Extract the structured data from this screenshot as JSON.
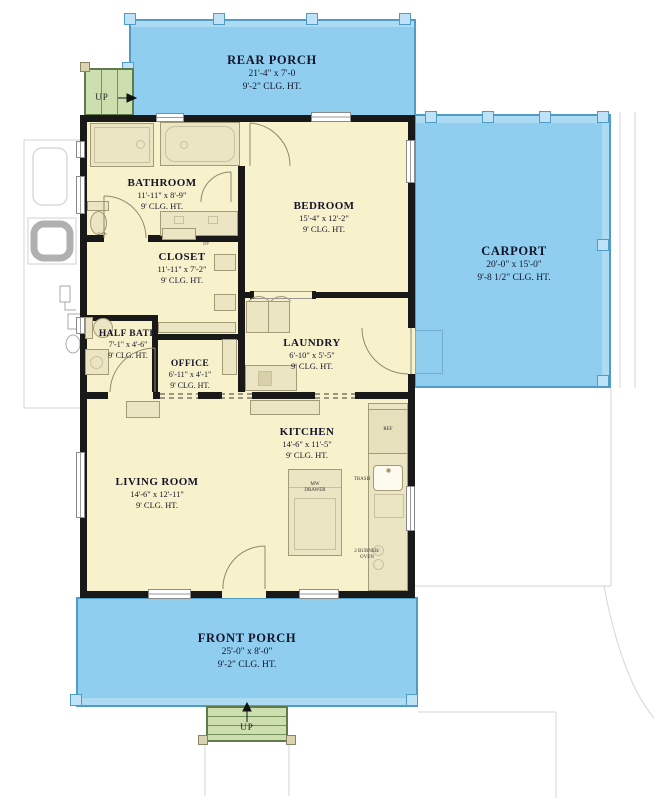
{
  "plan": {
    "rooms": {
      "rear_porch": {
        "name": "REAR PORCH",
        "dims": "21'-4\" x 7'-0",
        "clg": "9'-2\" CLG. HT."
      },
      "carport": {
        "name": "CARPORT",
        "dims": "20'-0\" x 15'-0\"",
        "clg": "9'-8 1/2\" CLG. HT."
      },
      "bathroom": {
        "name": "BATHROOM",
        "dims": "11'-11\" x 8'-9\"",
        "clg": "9' CLG. HT."
      },
      "bedroom": {
        "name": "BEDROOM",
        "dims": "15'-4\" x 12'-2\"",
        "clg": "9' CLG. HT."
      },
      "closet": {
        "name": "CLOSET",
        "dims": "11'-11\" x 7'-2\"",
        "clg": "9' CLG. HT."
      },
      "half_bath": {
        "name": "HALF BATH",
        "dims": "7'-1\" x 4'-6\"",
        "clg": "9' CLG. HT."
      },
      "office": {
        "name": "OFFICE",
        "dims": "6'-11\" x 4'-1\"",
        "clg": "9' CLG. HT."
      },
      "laundry": {
        "name": "LAUNDRY",
        "dims": "6'-10\" x 5'-5\"",
        "clg": "9' CLG. HT."
      },
      "kitchen": {
        "name": "KITCHEN",
        "dims": "14'-6\" x 11'-5\"",
        "clg": "9' CLG. HT."
      },
      "living_room": {
        "name": "LIVING ROOM",
        "dims": "14'-6\" x 12'-11\"",
        "clg": "9' CLG. HT."
      },
      "front_porch": {
        "name": "FRONT PORCH",
        "dims": "25'-0\" x 8'-0\"",
        "clg": "9'-2\" CLG. HT."
      }
    },
    "annotations": {
      "stairs_rear_up": "UP",
      "stairs_front_up": "UP",
      "ref": "REF",
      "trash": "TRASH",
      "mw_line1": "MW",
      "mw_line2": "DRAWER",
      "burner_line1": "2 BURNER/",
      "burner_line2": "OVEN",
      "lumber": "2 x 6",
      "dp": "DP"
    },
    "colors": {
      "porch": "#8fceef",
      "porch_border": "#4f9dc7",
      "porch_post": "#bfe2f6",
      "house": "#f8f2cc",
      "wall": "#191919",
      "stairs": "#cddfae",
      "stairs_border": "#5f7a4b",
      "fixture": "#ece5c3",
      "fixture_border": "#a39a76",
      "window_border": "#8a8a8a",
      "text": "#14142a",
      "faint": "#dcdcdc"
    }
  }
}
